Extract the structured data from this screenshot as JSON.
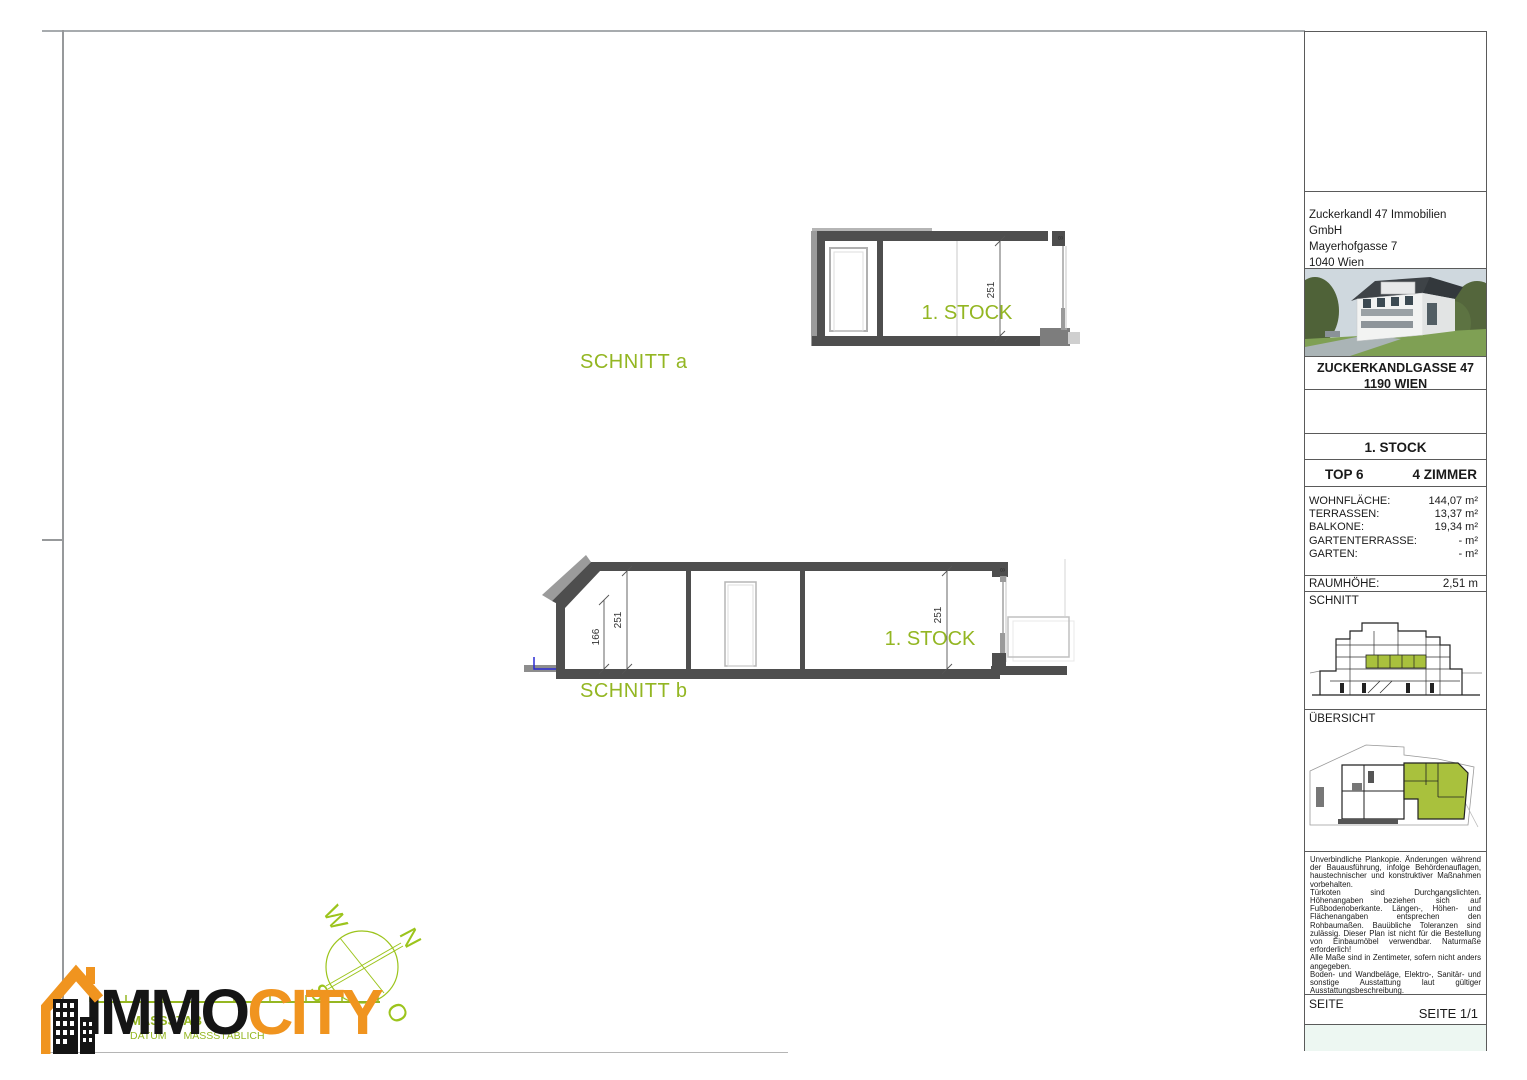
{
  "drawings": {
    "schnitt_a": {
      "title": "SCHNITT a",
      "room_label": "1. STOCK",
      "dim_height": "251",
      "corner_dim": "8"
    },
    "schnitt_b": {
      "title": "SCHNITT b",
      "room_label": "1. STOCK",
      "dim_left_outer": "166",
      "dim_left_inner": "251",
      "dim_right": "251",
      "corner_dim": "8"
    }
  },
  "compass": {
    "west": "W",
    "north": "N",
    "south": "S",
    "east": "O"
  },
  "logo": {
    "immo": "IMMO",
    "city": "CITY",
    "scale_label": "MASSSTAB",
    "scale_note": "DATUM  MASSSTÄBLICH"
  },
  "titleblock": {
    "company_lines": [
      "Zuckerkandl 47 Immobilien GmbH",
      "Mayerhofgasse 7",
      "1040 Wien"
    ],
    "project_title": "ZUCKERKANDLGASSE 47",
    "project_subtitle": "1190 WIEN",
    "floor_title": "1. STOCK",
    "unit": "TOP 6",
    "rooms": "4 ZIMMER",
    "areas": [
      {
        "label": "WOHNFLÄCHE:",
        "value": "144,07 m²"
      },
      {
        "label": "TERRASSEN:",
        "value": "13,37 m²"
      },
      {
        "label": "BALKONE:",
        "value": "19,34 m²"
      },
      {
        "label": "GARTENTERRASSE:",
        "value": "- m²"
      },
      {
        "label": "GARTEN:",
        "value": "- m²"
      }
    ],
    "room_height_label": "RAUMHÖHE:",
    "room_height_value": "2,51 m",
    "schnitt_section_label": "SCHNITT",
    "uebersicht_section_label": "ÜBERSICHT",
    "legal_paragraphs": [
      "Unverbindliche Plankopie. Änderungen während der Bauausführung, infolge Behördenauflagen, haustechnischer und konstruktiver Maßnahmen vorbehalten.",
      "Türkoten sind Durchgangslichten. Höhenangaben beziehen sich auf Fußbodenoberkante. Längen-, Höhen- und Flächenangaben entsprechen den Rohbaumaßen. Bauübliche Toleranzen sind zulässig. Dieser Plan ist nicht für die Bestellung von Einbaumöbel verwendbar. Naturmaße erforderlich!",
      "Alle Maße sind in Zentimeter, sofern nicht anders angegeben.",
      "Boden- und Wandbeläge, Elektro-, Sanitär- und sonstige Ausstattung laut gültiger Ausstattungsbeschreibung."
    ],
    "seite_label": "SEITE",
    "seite_value": "SEITE 1/1"
  },
  "colors": {
    "accent_green": "#93b622",
    "compass_green": "#9cc41c",
    "logo_orange": "#F0941F",
    "wall_dark": "#4e4e4e",
    "highlight_green": "#a9c13d",
    "footer_tint": "#edf7f2"
  }
}
